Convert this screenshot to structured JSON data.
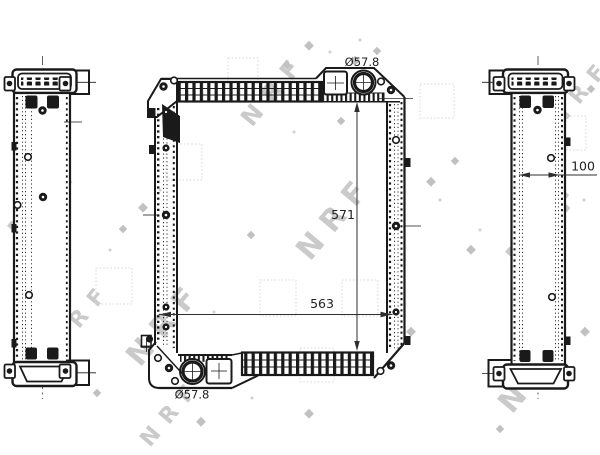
{
  "brand_watermark": "NRF",
  "labels": {
    "top_port_diameter": "Ø57.8",
    "core_height": "571",
    "core_width": "563",
    "bottom_port_diameter": "Ø57.8",
    "depth": "100"
  },
  "colors": {
    "line": "#1a1a1a",
    "dimension_text": "#222222",
    "watermark": "#9e9e9e",
    "background": "#ffffff"
  }
}
